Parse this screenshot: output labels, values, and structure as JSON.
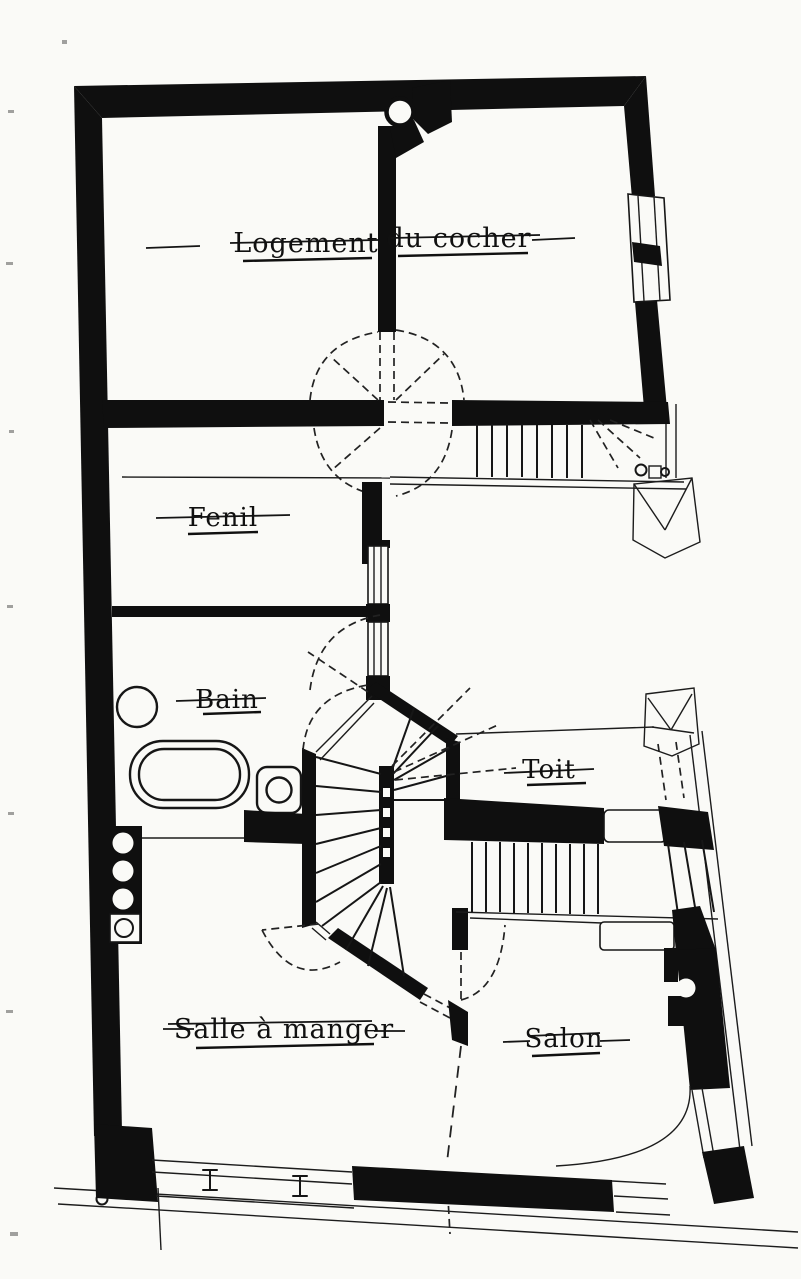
{
  "page": {
    "paper_color": "#fafaf7",
    "ink_color": "#0f0f0f"
  },
  "rooms": {
    "logement_word1": "Logement",
    "logement_word2": "du cocher",
    "fenil": "Fenil",
    "bain": "Bain",
    "toit": "Toit",
    "salle_a_manger": "Salle à manger",
    "salon": "Salon"
  }
}
